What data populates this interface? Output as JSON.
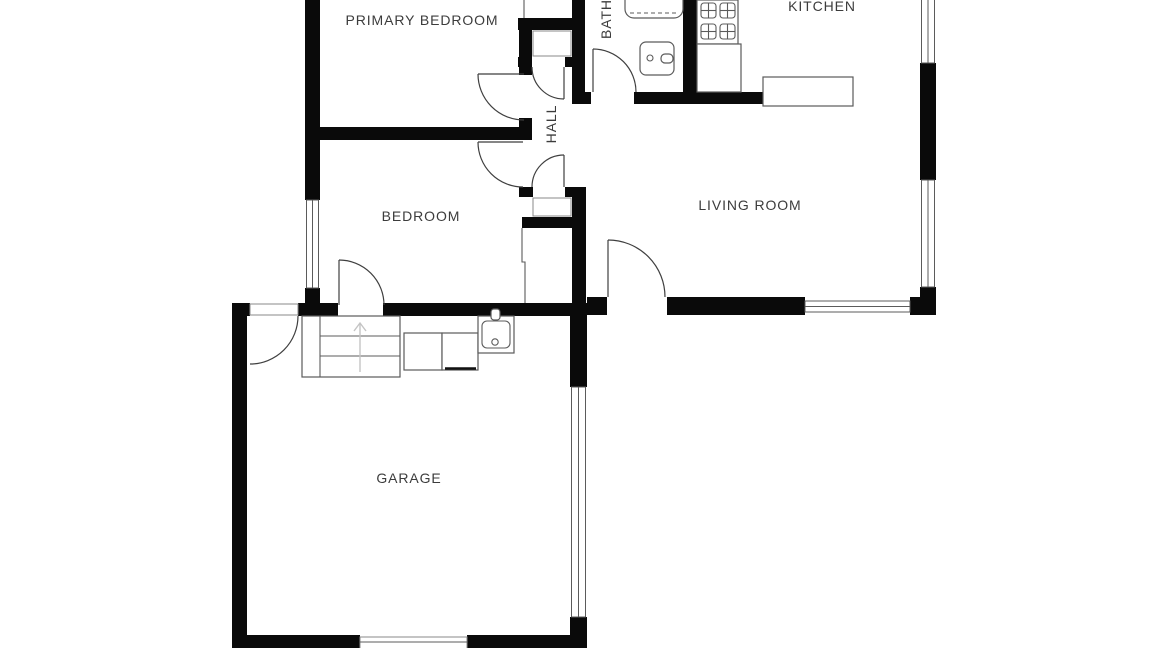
{
  "title": "Floor plan",
  "rooms": {
    "primary_bedroom": {
      "label": "PRIMARY BEDROOM"
    },
    "bedroom": {
      "label": "BEDROOM"
    },
    "bath": {
      "label": "BATH"
    },
    "hall": {
      "label": "HALL"
    },
    "kitchen": {
      "label": "KITCHEN"
    },
    "living_room": {
      "label": "LIVING ROOM"
    },
    "garage": {
      "label": "GARAGE"
    }
  },
  "fixtures": [
    "bathtub",
    "bathroom-sink",
    "stove-4-burner",
    "kitchen-counter",
    "kitchen-island",
    "stairs-up",
    "washer",
    "dryer",
    "utility-sink",
    "garage-door-panel"
  ],
  "colors": {
    "background": "#ffffff",
    "wall": "#0a0a0a",
    "fixture_line": "#5b5b5b",
    "door_arc": "#3f3f3f",
    "label_text": "#3c3c3c",
    "faint_arrow": "#c4c4c4"
  }
}
